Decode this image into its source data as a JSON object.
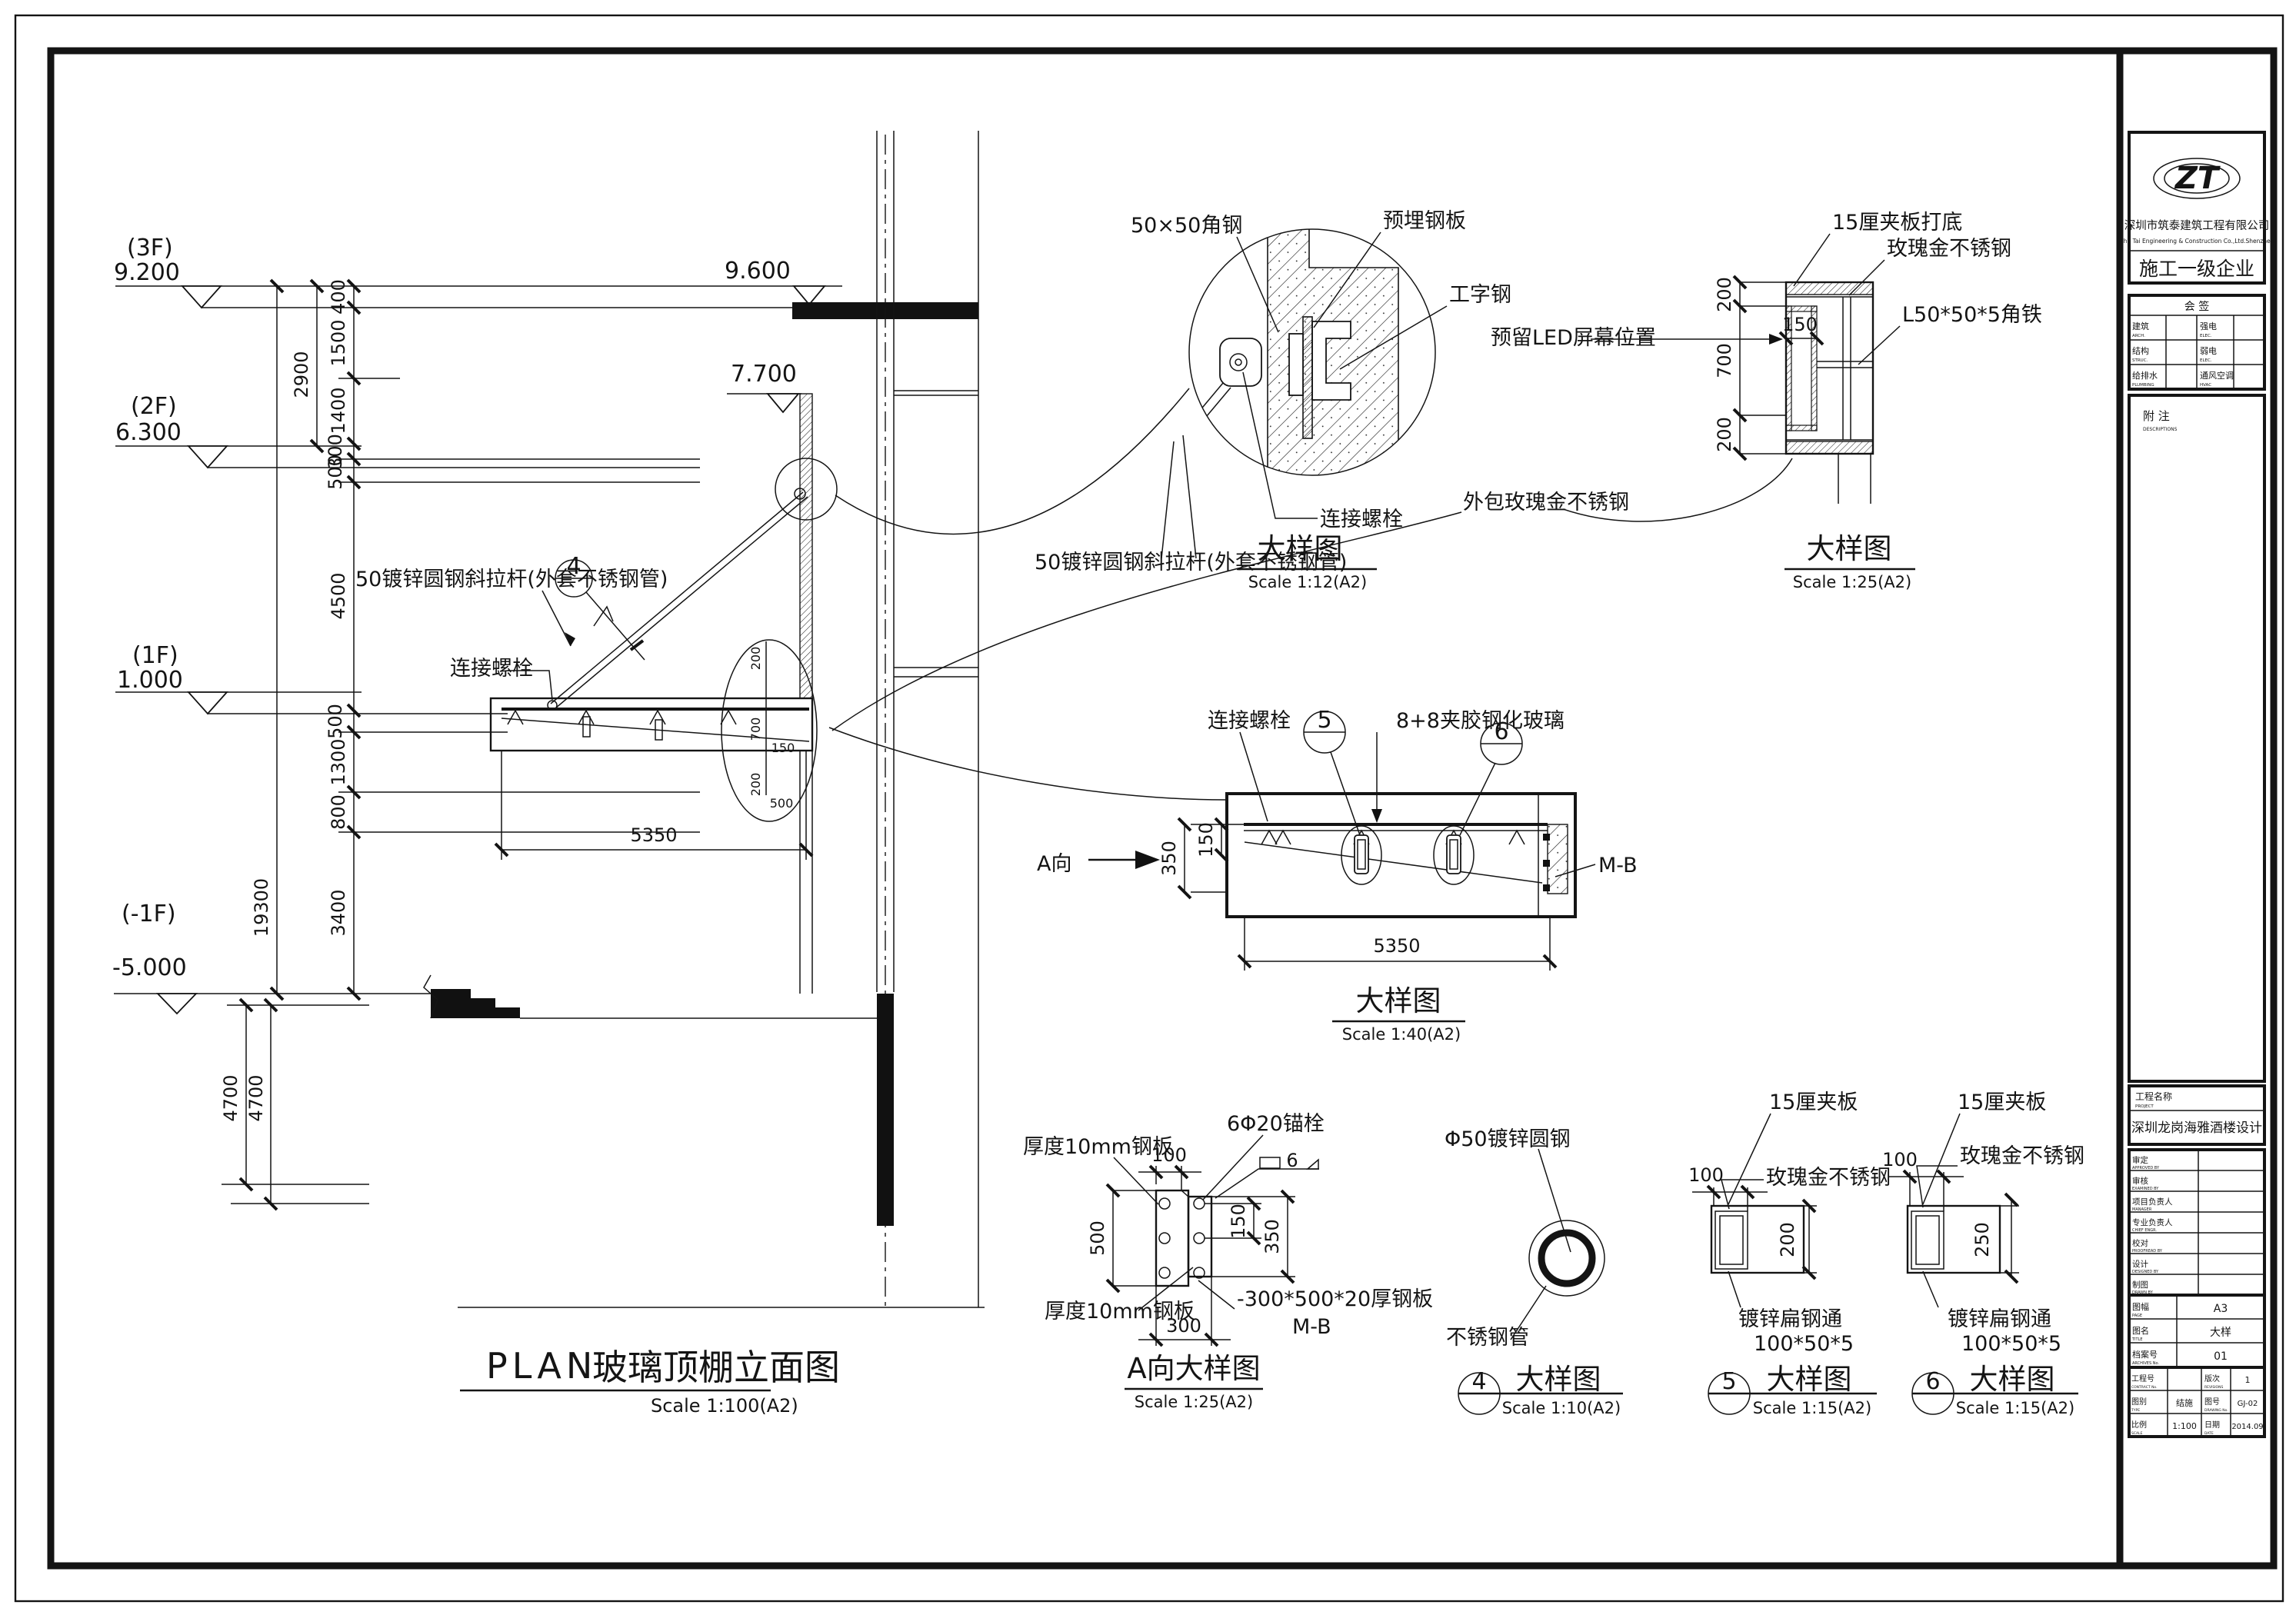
{
  "sheet": {
    "title_en": "PLAN",
    "title_cn": "玻璃顶棚立面图",
    "scale": "Scale 1:100(A2)"
  },
  "levels": {
    "f3": "(3F)",
    "e92": "9.200",
    "f2": "(2F)",
    "e63": "6.300",
    "f1": "(1F)",
    "e10": "1.000",
    "fb1": "(-1F)",
    "e5000": "-5.000",
    "e96": "9.600",
    "e77": "7.700"
  },
  "dims": {
    "d100": "100",
    "d150": "150",
    "d200": "200",
    "d250": "250",
    "d300": "300",
    "d350": "350",
    "d400": "400",
    "d500": "500",
    "d700": "700",
    "d800": "800",
    "d1300": "1300",
    "d1400": "1400",
    "d1500": "1500",
    "d2900": "2900",
    "d3400": "3400",
    "d4500": "4500",
    "d4700": "4700",
    "d5350": "5350",
    "d19300": "19300"
  },
  "labels": {
    "tie_rod": "50镀锌圆钢斜拉杆(外套不锈钢管)",
    "bolt": "连接螺栓",
    "angle5050": "50×50角钢",
    "embed": "预埋钢板",
    "ibeam": "工字钢",
    "ply15_base": "15厘夹板打底",
    "rose_gold": "玫瑰金不锈钢",
    "angle_iron": "L50*50*5角铁",
    "led": "预留LED屏幕位置",
    "wrap": "外包玫瑰金不锈钢",
    "glass88": "8+8夹胶钢化玻璃",
    "mb": "M-B",
    "a_dir": "A向",
    "plate10": "厚度10mm钢板",
    "anchor620": "6Φ20锚栓",
    "base_plate": "-300*500*20厚钢板",
    "weld6": "6",
    "rod50": "Φ50镀锌圆钢",
    "ss_tube": "不锈钢管",
    "ply15": "15厘夹板",
    "flat_steel": "镀锌扁钢通",
    "flat_size": "100*50*5"
  },
  "details": {
    "ref4": "4",
    "ref5": "5",
    "ref6": "6",
    "d1": {
      "title": "大样图",
      "scale": "Scale 1:12(A2)"
    },
    "d2": {
      "title": "大样图",
      "scale": "Scale 1:25(A2)"
    },
    "d3": {
      "title": "大样图",
      "scale": "Scale 1:40(A2)"
    },
    "dA": {
      "title": "A向大样图",
      "scale": "Scale 1:25(A2)"
    },
    "d4": {
      "ref": "4",
      "title": "大样图",
      "scale": "Scale 1:10(A2)"
    },
    "d5": {
      "ref": "5",
      "title": "大样图",
      "scale": "Scale 1:15(A2)"
    },
    "d6": {
      "ref": "6",
      "title": "大样图",
      "scale": "Scale 1:15(A2)"
    }
  },
  "title_block": {
    "logo_text": "ZT",
    "company": "深圳市筑泰建筑工程有限公司",
    "company_en": "Zhu Tai Engineering & Construction Co.,Ltd.Shenzhen",
    "grade": "施工一级企业",
    "sign_title": "会 签",
    "sign": {
      "r1c1": "建筑",
      "r1c1en": "ARCH.",
      "r1c2": "强电",
      "r1c2en": "ELEC.",
      "r2c1": "结构",
      "r2c1en": "STRUC.",
      "r2c2": "弱电",
      "r2c2en": "ELEC.",
      "r3c1": "给排水",
      "r3c1en": "PLUMBING",
      "r3c2": "通风空调",
      "r3c2en": "HVAC"
    },
    "remark": "附 注",
    "remark_en": "DESCRIPTIONS",
    "project_label": "工程名称",
    "project_label_en": "PROJECT",
    "project_name": "深圳龙岗海雅酒楼设计",
    "rows": {
      "r1": "审定",
      "r1en": "APPROVED BY",
      "r2": "审核",
      "r2en": "EXAMINED BY",
      "r3": "项目负责人",
      "r3en": "MANAGER",
      "r4": "专业负责人",
      "r4en": "CHIEF ENGR.",
      "r5": "校对",
      "r5en": "PROOFREAD BY",
      "r6": "设计",
      "r6en": "DESIGNED BY",
      "r7": "制图",
      "r7en": "DRAWN BY"
    },
    "info": {
      "size_label": "图幅",
      "size_en": "PAGE",
      "size": "A3",
      "name_label": "图名",
      "name_en": "TITLE",
      "name": "大样",
      "file_label": "档案号",
      "file_en": "ARCHIVES No.",
      "file": "01"
    },
    "footer": {
      "contract_label": "工程号",
      "contract_en": "CONTRACT No.",
      "contract": "",
      "rev_label": "版次",
      "rev_en": "REVISIONS",
      "rev": "1",
      "cat_label": "图别",
      "cat_en": "TYPE",
      "cat": "结施",
      "no_label": "图号",
      "no_en": "DRAWING No.",
      "no": "GJ-02",
      "scale_label": "比例",
      "scale_en": "SCALE",
      "scale": "1:100",
      "date_label": "日期",
      "date_en": "DATE",
      "date": "2014.09"
    }
  }
}
